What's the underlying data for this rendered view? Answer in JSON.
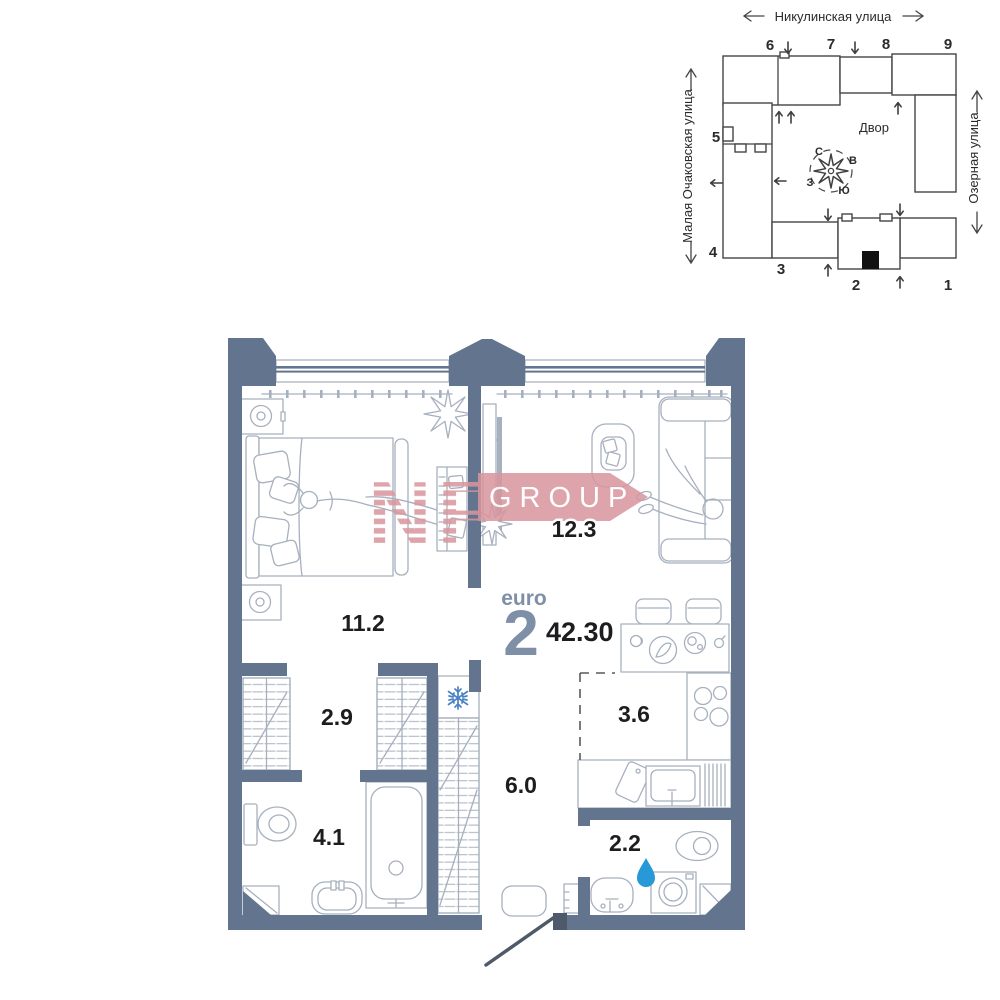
{
  "unit": {
    "type_label": "euro",
    "rooms_label": "2",
    "total_area": "42.30"
  },
  "rooms": {
    "bedroom": "11.2",
    "living_room": "12.3",
    "hallway": "2.9",
    "kitchen": "3.6",
    "corridor": "6.0",
    "bathroom": "4.1",
    "wc": "2.2"
  },
  "watermark": {
    "letters": "NF",
    "word": "GROUP"
  },
  "site_plan": {
    "street_top": "Никулинская улица",
    "street_left": "Малая Очаковская улица",
    "street_right": "Озерная улица",
    "courtyard": "Двор",
    "compass": {
      "north": "С",
      "east": "В",
      "south": "Ю",
      "west": "З"
    },
    "buildings": {
      "b1": "1",
      "b2": "2",
      "b3": "3",
      "b4": "4",
      "b5": "5",
      "b6": "6",
      "b7": "7",
      "b8": "8",
      "b9": "9"
    }
  },
  "colors": {
    "wall": "#62748E",
    "watermark_pink": "#D9959D",
    "water_drop_blue": "#2699D6",
    "snowflake_blue": "#4A82C3",
    "highlight_building": "#E4E4E4"
  }
}
